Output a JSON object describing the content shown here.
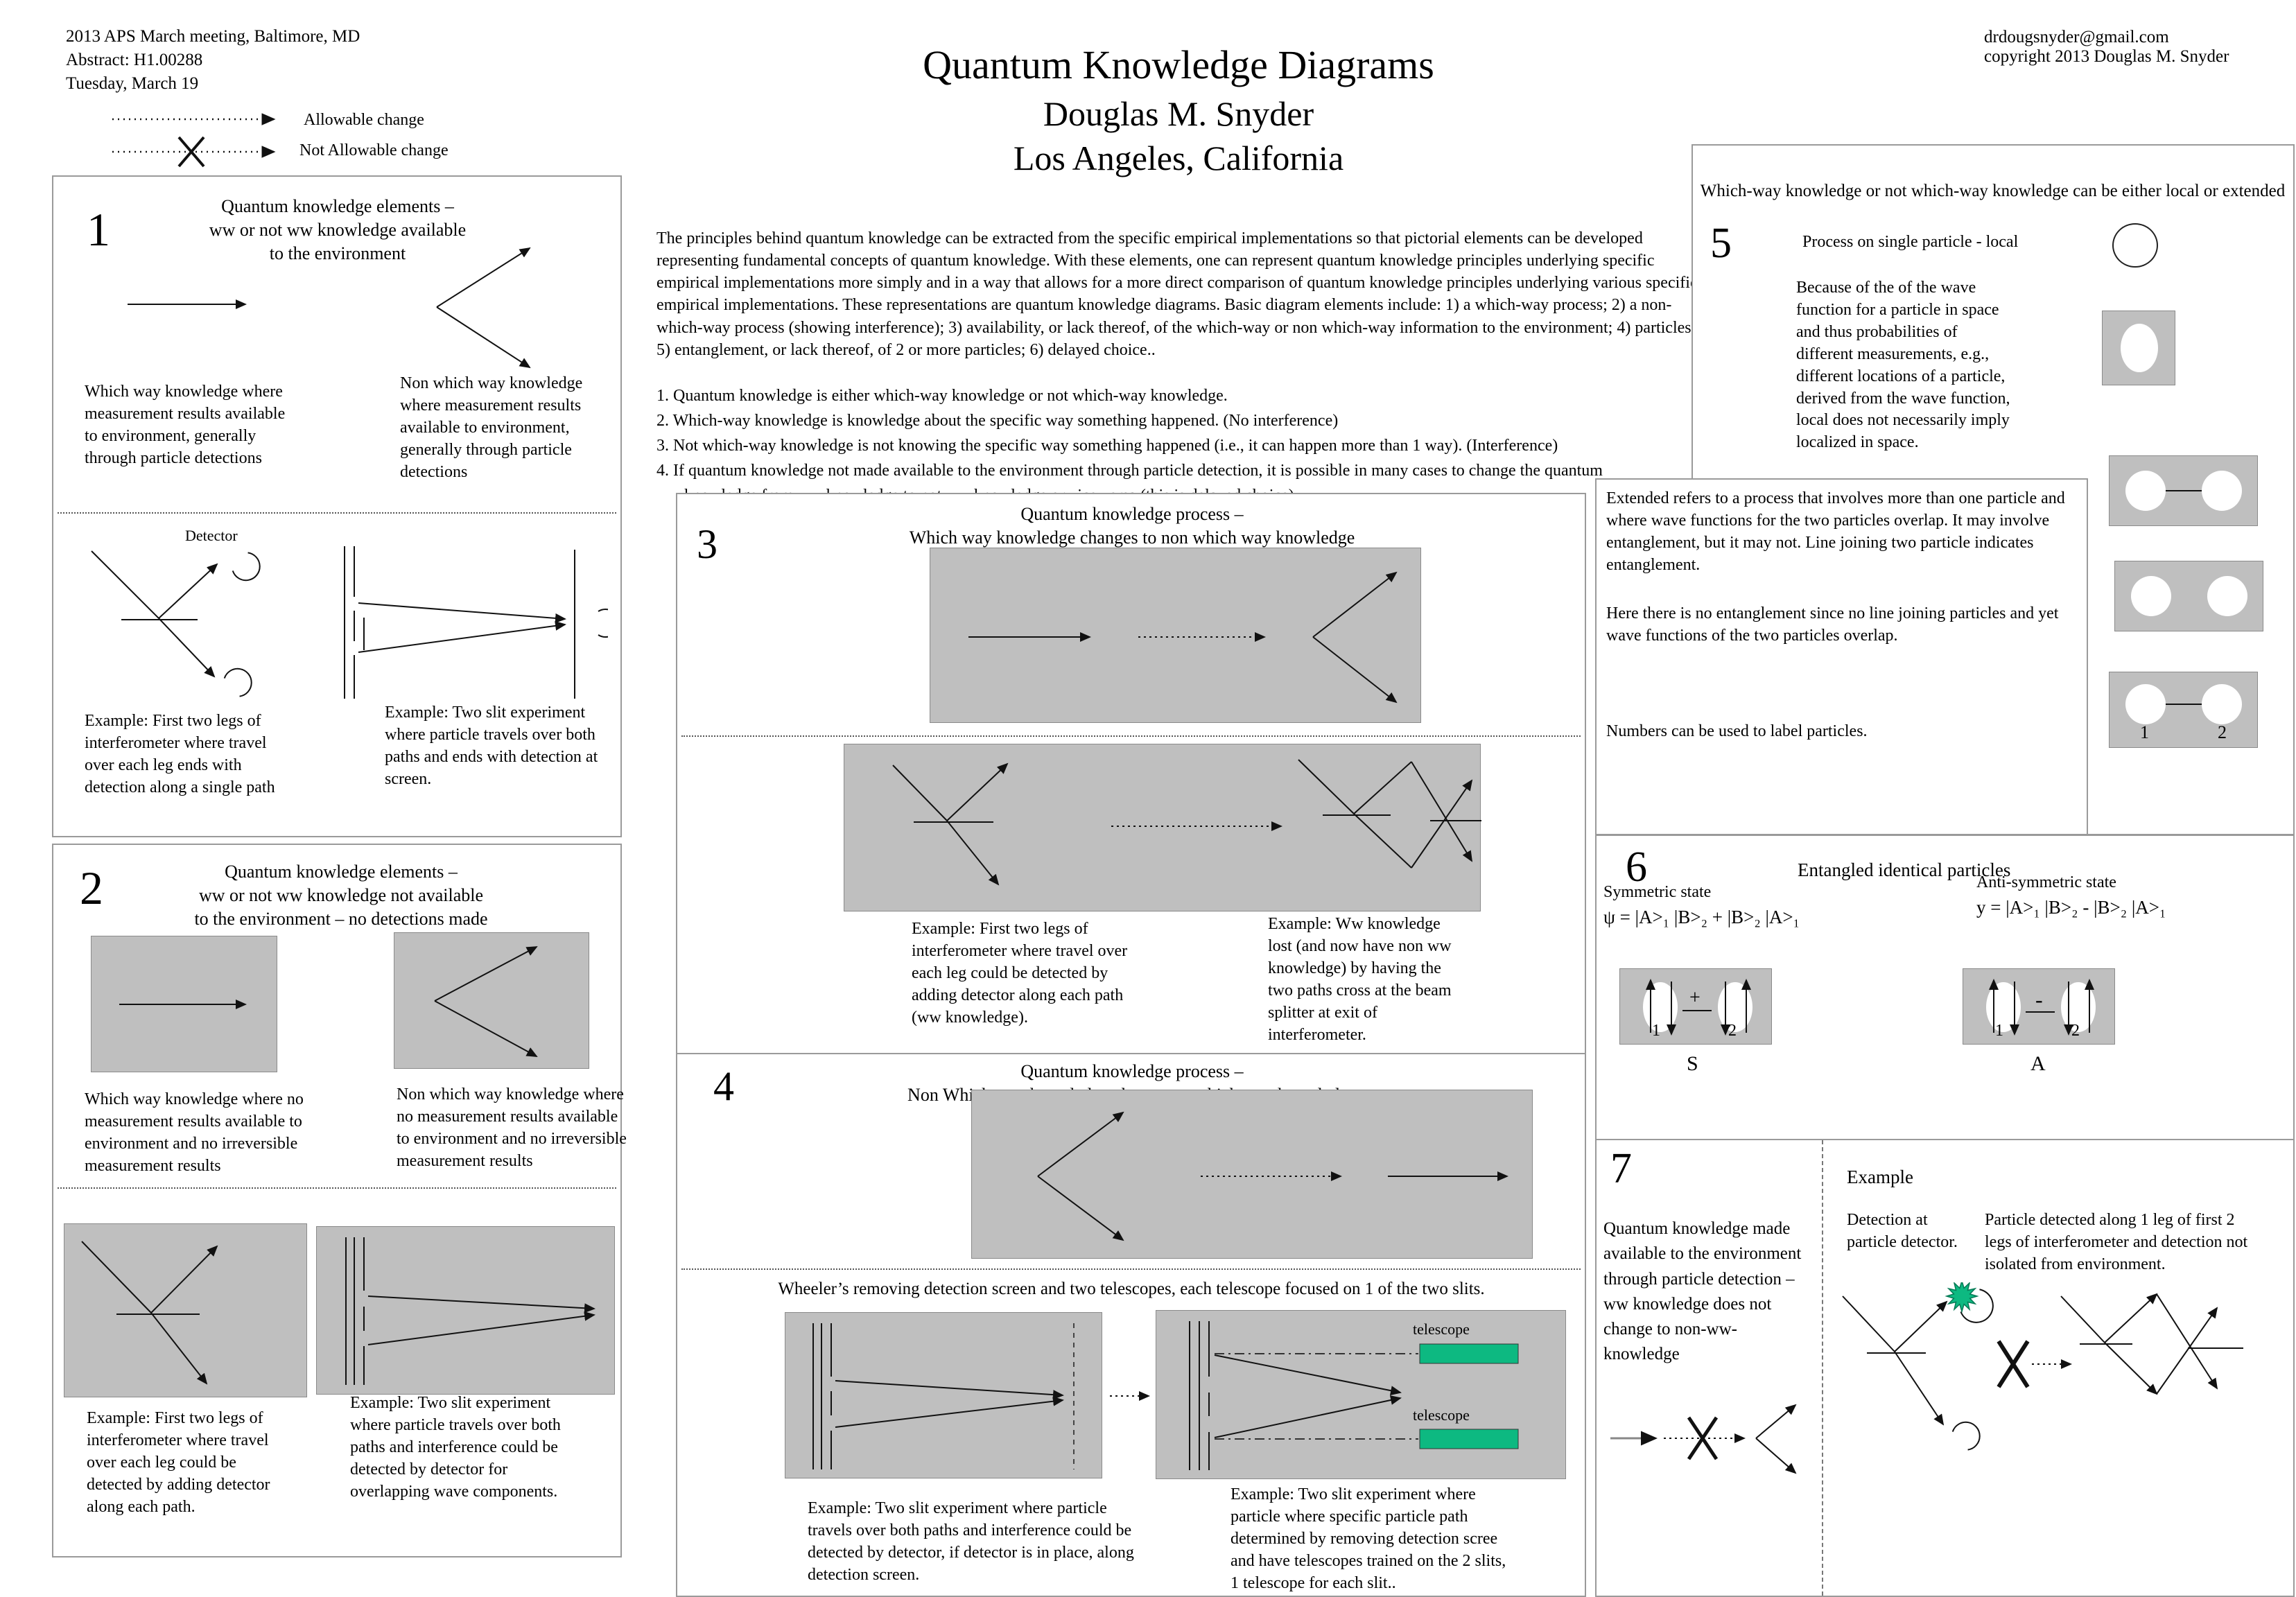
{
  "header_left": {
    "line1": "2013 APS March meeting, Baltimore, MD",
    "line2": "Abstract: H1.00288",
    "line3": "Tuesday, March 19"
  },
  "legend": {
    "allowable": "Allowable change",
    "not_allowable": "Not Allowable change"
  },
  "title": {
    "line1": "Quantum Knowledge Diagrams",
    "line2": "Douglas M. Snyder",
    "line3": "Los Angeles, California"
  },
  "contact": {
    "email": "drdougsnyder@gmail.com",
    "copyright": "copyright 2013 Douglas M. Snyder"
  },
  "intro": {
    "paragraph": "The principles behind quantum knowledge can be extracted from the specific empirical implementations so that pictorial elements can be developed  representing fundamental concepts of quantum knowledge.  With these elements, one can represent quantum knowledge principles underlying specific empirical implementations more simply and in a way that allows for a more direct comparison of quantum knowledge principles underlying various specific empirical implementations.  These representations are quantum knowledge diagrams.  Basic diagram elements include: 1) a which-way process; 2) a non-which-way process (showing interference); 3) availability, or lack thereof, of the which-way or non which-way information to the environment; 4) particles; 5) entanglement, or lack thereof, of 2 or more particles; 6) delayed choice..",
    "item1": "1. Quantum knowledge is either which-way knowledge or not which-way knowledge.",
    "item2": "2. Which-way knowledge is knowledge about the specific way something happened.  (No interference)",
    "item3": "3. Not which-way knowledge is not knowing the specific way something happened (i.e., it can happen more than 1 way).   (Interference)",
    "item4": "4. If quantum knowledge not made available to the environment through particle detection, it is possible in many cases to change the quantum",
    "item4_cont": "knowledge from ww knowledge to not ww knowledge or vice versa (this is delayed choice)"
  },
  "section1": {
    "number": "1",
    "header": "Quantum knowledge elements –\nww or not ww knowledge available\nto the environment",
    "ww_caption": "Which way knowledge where measurement results available to environment, generally through particle detections",
    "nww_caption": "Non which way knowledge where measurement results available to environment, generally through particle detections",
    "detector_label": "Detector",
    "example_left": "Example: First two legs of interferometer where travel over each leg ends with detection along a single path",
    "example_right": "Example: Two slit experiment where particle travels over both paths and ends with detection at screen."
  },
  "section2": {
    "number": "2",
    "header": "Quantum knowledge elements –\nww or not ww knowledge not available\nto the environment – no detections made",
    "ww_caption": "Which way knowledge where no measurement results available to environment and no irreversible measurement results",
    "nww_caption": "Non which way knowledge where no measurement results available to environment and no irreversible measurement results",
    "example_left": "Example: First two legs of interferometer where travel over each leg could be detected  by adding detector along each path.",
    "example_right": "Example: Two slit experiment where particle travels over both paths and interference could be detected by detector for overlapping wave components."
  },
  "section3": {
    "number": "3",
    "header": "Quantum knowledge process –\nWhich way knowledge changes to non which way knowledge",
    "example_left": "Example: First two legs of interferometer where travel over each leg could be detected  by adding detector along each path (ww knowledge).",
    "example_right": "Example: Ww knowledge lost (and now have non ww knowledge) by having the two paths cross at the beam splitter at exit of interferometer."
  },
  "section4": {
    "number": "4",
    "header": "Quantum knowledge process –\nNon Which way knowledge changes to which way knowledge",
    "wheeler": "Wheeler’s removing detection screen and two telescopes, each telescope focused on 1 of the two slits.",
    "telescope_label": "telescope",
    "example_left": "Example: Two slit experiment where particle travels over both paths and interference could be detected by detector, if detector is in place, along detection screen.",
    "example_right": "Example: Two slit experiment where particle where specific particle path determined by removing detection scree and have telescopes trained on the 2 slits, 1 telescope for each slit.."
  },
  "section5": {
    "header": "Which-way knowledge or not which-way knowledge can be either local or extended",
    "number": "5",
    "process_label": "Process on single particle  - local",
    "because": "Because of the of the wave function for a particle in space and thus probabilities of different measurements, e.g., different locations of a particle, derived from the wave function, local does not necessarily imply localized in space.",
    "extended": "Extended refers to a process that involves more than one particle and where wave functions for the two particles overlap.  It may involve entanglement, but it may not. Line joining two particle indicates entanglement.",
    "here": "Here there is no entanglement since no line joining particles and yet wave functions of the two particles overlap.",
    "numbers": "Numbers can be used to label particles.",
    "particle1": "1",
    "particle2": "2"
  },
  "section6": {
    "number": "6",
    "header": "Entangled identical particles",
    "symmetric_label": "Symmetric state",
    "symmetric_eq": "ψ = |A>₁ |B>₂ + |B>₂ |A>₁",
    "anti_label": "Anti-symmetric state",
    "anti_eq": "y = |A>₁ |B>₂ - |B>₂ |A>₁",
    "plus": "+",
    "minus": "-",
    "particle1": "1",
    "particle2": "2",
    "s_label": "S",
    "a_label": "A"
  },
  "section7": {
    "number": "7",
    "text": "Quantum knowledge made available to the environment through particle detection – ww knowledge does not change to non-ww- knowledge",
    "example_label": "Example",
    "detection_caption": "Detection at particle detector.",
    "particle_caption": "Particle detected along 1 leg of  first 2 legs of interferometer and detection not isolated from environment."
  },
  "colors": {
    "box_gray": "#bfbfbf",
    "telescope_green": "#0db981"
  }
}
